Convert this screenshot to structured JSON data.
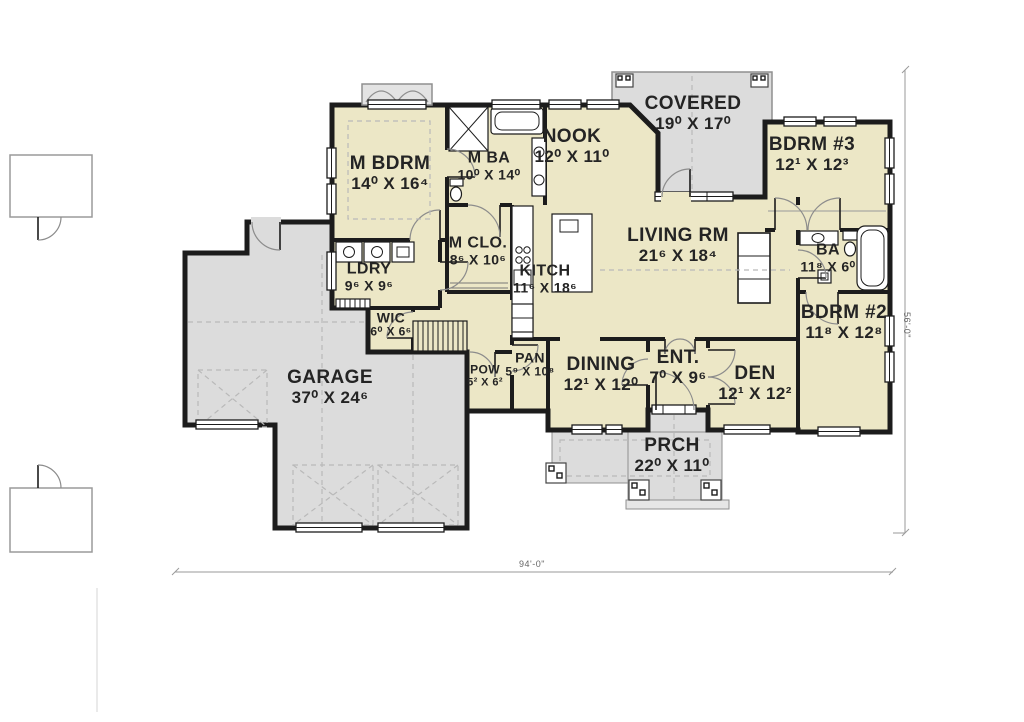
{
  "plan": {
    "type": "floor-plan",
    "rooms": [
      {
        "id": "m_bdrm",
        "name": "M BDRM",
        "dims": "14⁰ X 16⁴"
      },
      {
        "id": "m_ba",
        "name": "M BA",
        "dims": "10⁰ X 14⁰"
      },
      {
        "id": "nook",
        "name": "NOOK",
        "dims": "12⁰ X 11⁰"
      },
      {
        "id": "covered",
        "name": "COVERED",
        "dims": "19⁰ X 17⁰"
      },
      {
        "id": "bdrm3",
        "name": "BDRM #3",
        "dims": "12¹ X 12³"
      },
      {
        "id": "living",
        "name": "LIVING RM",
        "dims": "21⁶ X 18⁴"
      },
      {
        "id": "ba",
        "name": "BA",
        "dims": "11⁸ X 6⁰"
      },
      {
        "id": "m_clo",
        "name": "M CLO.",
        "dims": "8⁶ X 10⁶"
      },
      {
        "id": "kitch",
        "name": "KITCH",
        "dims": "11⁶ X 18⁶"
      },
      {
        "id": "ldry",
        "name": "LDRY",
        "dims": "9⁶ X 9⁶"
      },
      {
        "id": "wic",
        "name": "WIC",
        "dims": "6⁰ X 6⁶"
      },
      {
        "id": "bdrm2",
        "name": "BDRM #2",
        "dims": "11⁸ X 12⁸"
      },
      {
        "id": "garage",
        "name": "GARAGE",
        "dims": "37⁰ X 24⁶"
      },
      {
        "id": "pow",
        "name": "POW",
        "dims": "5² X 6²"
      },
      {
        "id": "pan",
        "name": "PAN",
        "dims": "5⁹ X 10⁸"
      },
      {
        "id": "dining",
        "name": "DINING",
        "dims": "12¹ X 12⁰"
      },
      {
        "id": "ent",
        "name": "ENT.",
        "dims": "7⁰ X 9⁶"
      },
      {
        "id": "den",
        "name": "DEN",
        "dims": "12¹ X 12²"
      },
      {
        "id": "prch",
        "name": "PRCH",
        "dims": "22⁰ X 11⁰"
      }
    ],
    "dimensions": {
      "overall_width": "94'-0\"",
      "overall_height": "56'-0\""
    },
    "colors": {
      "room_fill": "#ece7c6",
      "outdoor_fill": "#dcdcdc",
      "wall": "#1c1c1c",
      "background": "#ffffff"
    }
  }
}
